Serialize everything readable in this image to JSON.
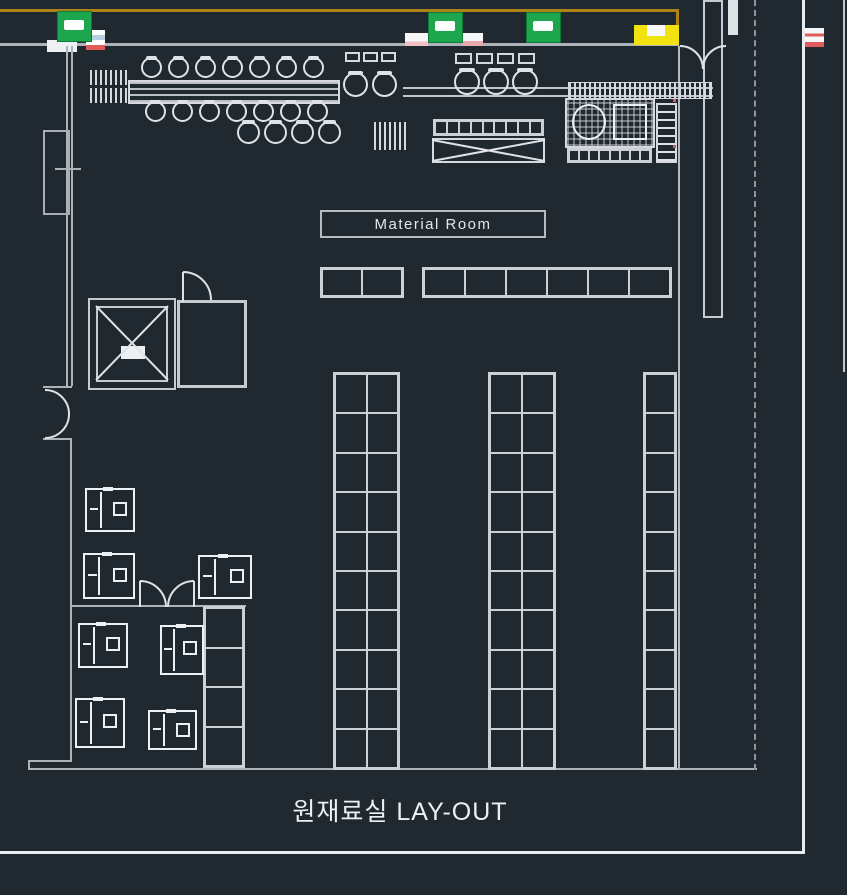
{
  "title_block": {
    "text": "원재료실 LAY-OUT"
  },
  "labels": {
    "material_room": "Material Room"
  },
  "signs": {
    "exit_sign_count": 3,
    "fire_box_count": 1
  },
  "storage": {
    "top_row_groups": [
      {
        "cells": 2
      },
      {
        "cells": 6
      }
    ],
    "vertical_racks": [
      {
        "cols": 2,
        "rows": 10
      },
      {
        "cols": 2,
        "rows": 10
      },
      {
        "cols": 1,
        "rows": 10
      }
    ],
    "side_ladder_cells": 4,
    "table_top_cells": 9,
    "equip_row_cells": 8
  },
  "equipment": {
    "machine_count": 7,
    "chair_count": 23
  },
  "colors": {
    "background": "#202830",
    "line_bright": "#e9ecef",
    "line_gray": "#aeb3ba",
    "gold": "#b08318",
    "yellow": "#f2e20e",
    "green": "#1ea64e",
    "red": "#e05c5c",
    "pink": "#f3bfc6",
    "blue_stripe": "#b9cfe2"
  }
}
